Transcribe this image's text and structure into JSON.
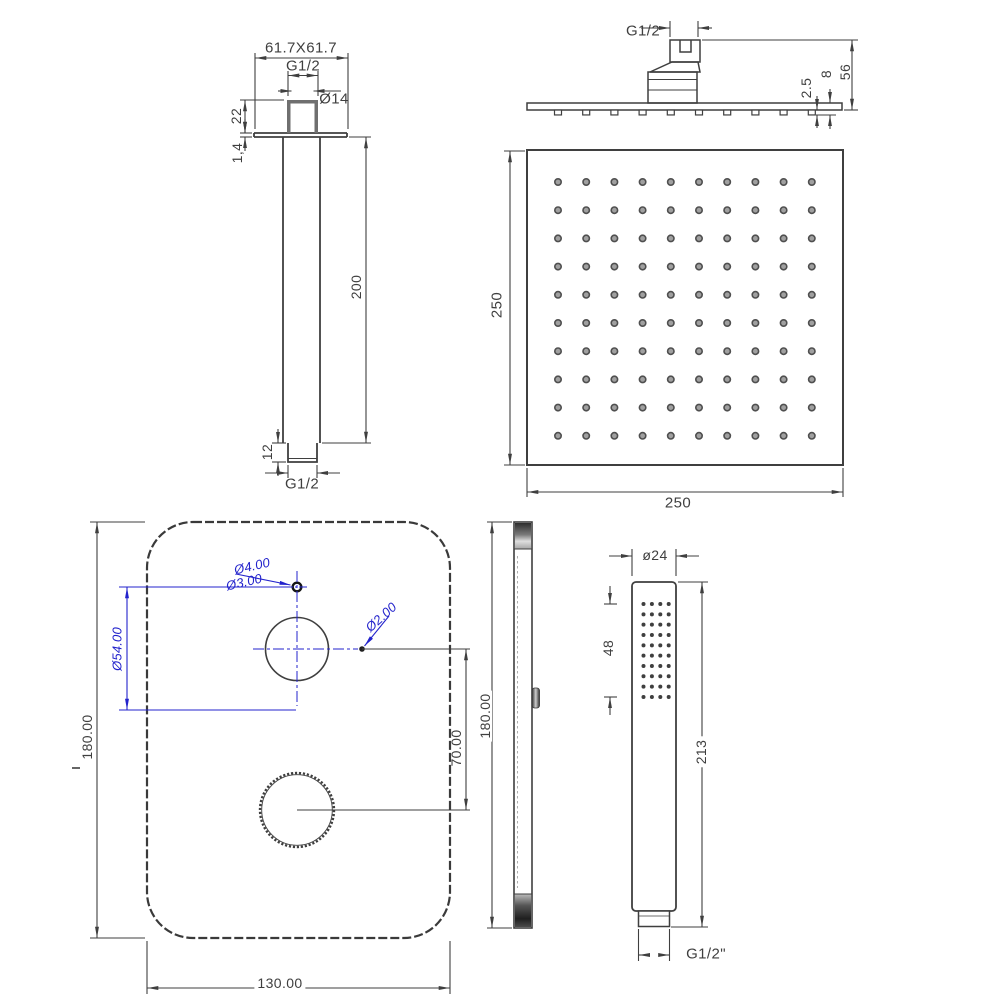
{
  "title": "Shower system technical drawing",
  "colors": {
    "line": "#3f3f3f",
    "annotation": "#2323cc"
  },
  "views": {
    "arm_front": {
      "dims": {
        "flange_size": "61.7X61.7",
        "top_thread": "G1/2",
        "bore": "Ø14",
        "stub_height": "22",
        "flange_thickness": "1,4",
        "arm_length": "200",
        "tip_length": "12",
        "bottom_thread": "G1/2"
      }
    },
    "head_side": {
      "dims": {
        "thread": "G1/2",
        "nozzle_protrusion": "2.5",
        "edge_thickness": "8",
        "total_height": "56"
      },
      "nozzle_grid": {
        "rows": 1,
        "cols": 10
      }
    },
    "head_face": {
      "dims": {
        "height": "250",
        "width": "250"
      },
      "nozzle_grid": {
        "rows": 10,
        "cols": 10
      }
    },
    "valve_front": {
      "dims": {
        "pilot_hole_outer": "Ø4.00",
        "pilot_hole_inner": "Ø3.00",
        "pin_hole": "Ø2.00",
        "knob_circle": "Ø54.00",
        "height": "180.00",
        "knob_spacing": "70.00",
        "width": "130.00"
      }
    },
    "valve_side": {
      "dims": {
        "height": "180.00"
      }
    },
    "hand_shower": {
      "dims": {
        "diameter": "ø24",
        "spray_length": "48",
        "total_length": "213",
        "thread": "G1/2\""
      },
      "nozzle_grid": {
        "rows": 10,
        "cols": 4
      }
    }
  }
}
